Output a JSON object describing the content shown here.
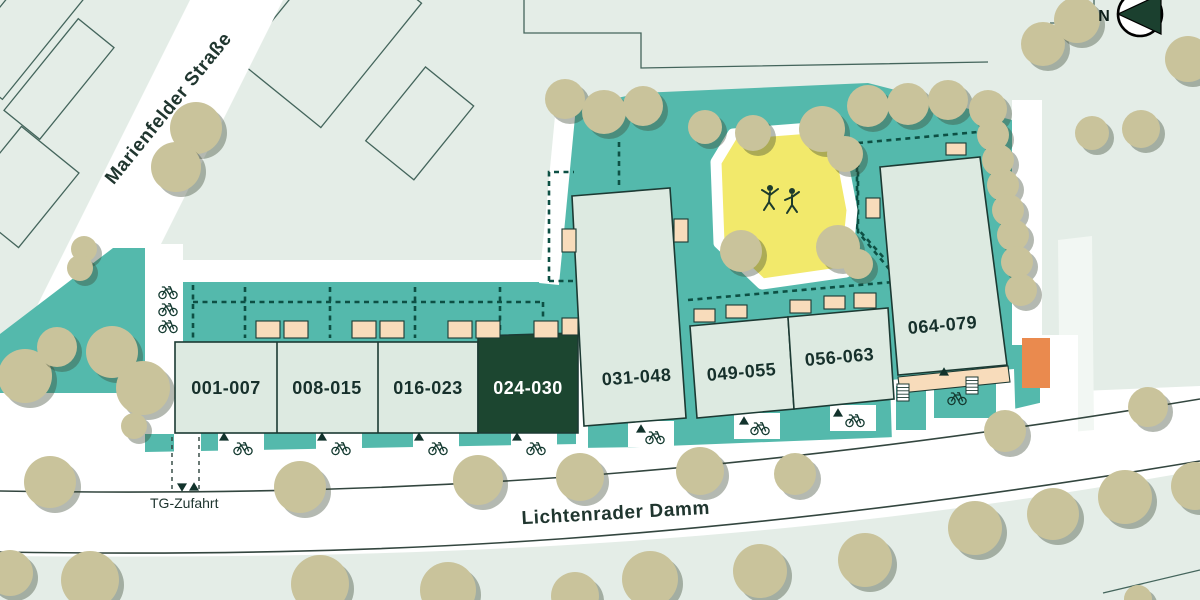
{
  "map": {
    "north_label": "N",
    "streets": {
      "marienfelder": "Marienfelder Straße",
      "lichtenrader": "Lichtenrader Damm"
    },
    "garage_label": "TG-Zufahrt",
    "buildings": [
      {
        "id": "001-007",
        "highlighted": false
      },
      {
        "id": "008-015",
        "highlighted": false
      },
      {
        "id": "016-023",
        "highlighted": false
      },
      {
        "id": "024-030",
        "highlighted": true
      },
      {
        "id": "031-048",
        "highlighted": false
      },
      {
        "id": "049-055",
        "highlighted": false
      },
      {
        "id": "056-063",
        "highlighted": false
      },
      {
        "id": "064-079",
        "highlighted": false
      }
    ],
    "icons": [
      "north-arrow-icon",
      "bicycle-icon",
      "playground-icon",
      "entrance-triangle-icon",
      "stairs-icon",
      "tree-icon"
    ],
    "colors": {
      "background": "#e4ede7",
      "site_teal": "#54b9ac",
      "building_fill": "#ddeae1",
      "building_highlight": "#1c4630",
      "building_outline": "#1c3a33",
      "terrace_peach": "#f8dcbb",
      "playground_yellow": "#f2e96b",
      "tree_olive": "#c9c39b",
      "accent_orange": "#ea8a4e",
      "dashed_line": "#0d5044",
      "path_white": "#ffffff"
    }
  }
}
